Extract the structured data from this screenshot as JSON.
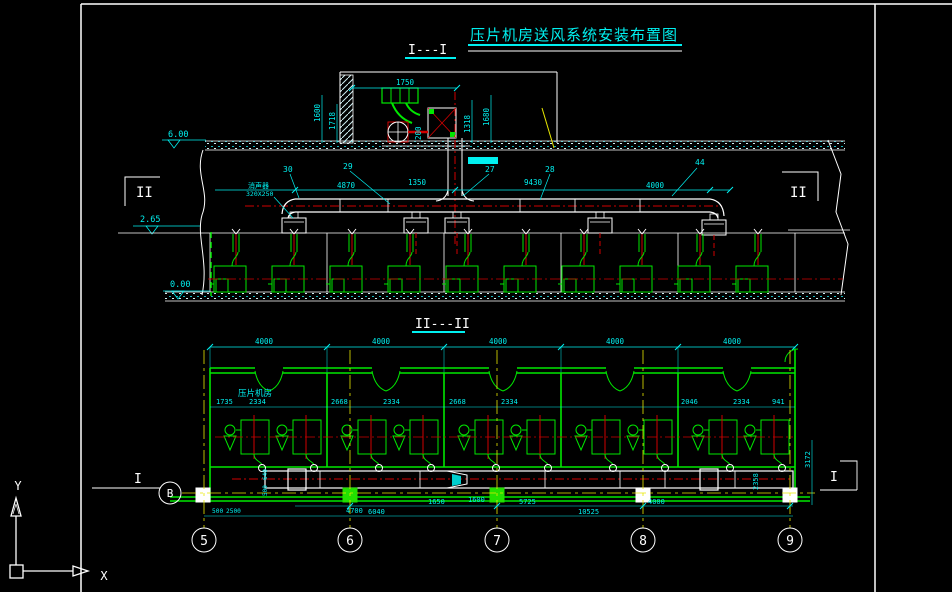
{
  "colors": {
    "bg": "#000000",
    "line": "#FFFFFF",
    "dim": "#00F0F0",
    "wall": "#00E800",
    "duct_center": "#D00000",
    "axis": "#E8E800"
  },
  "title": {
    "text": "压片机房送风系统安装布置图"
  },
  "section_labels": {
    "s1": "I---I",
    "s2": "II---II"
  },
  "elevation": {
    "levels": {
      "roof": "6.00",
      "mid": "2.65",
      "floor": "0.00"
    },
    "marks": {
      "left": "II",
      "right": "II"
    },
    "leaders": {
      "l30": "30",
      "l29": "29",
      "l27": "27",
      "l28": "28",
      "l44": "44"
    },
    "equip_note": {
      "line1": "消声器",
      "line2": "320X250"
    },
    "dims": {
      "d1750": "1750",
      "d200": "200",
      "d1600": "1600",
      "d1718": "1718",
      "d1318": "1318",
      "d1680": "1680",
      "d4870": "4870",
      "d1350": "1350",
      "d9430": "9430",
      "d4000": "4000"
    }
  },
  "plan": {
    "room_label": "压片机房",
    "marks": {
      "left": "I",
      "right": "I"
    },
    "top_dims": [
      "4000",
      "4000",
      "4000",
      "4000",
      "4000"
    ],
    "inner_dims": [
      "1735",
      "2334",
      "2668",
      "2334",
      "2668",
      "2334",
      "2046",
      "2334",
      "941"
    ],
    "bottom_dims": {
      "d500": "500",
      "d2500": "2500",
      "d4700": "4700",
      "d6040": "6040",
      "d1650": "1650",
      "d1600": "1600",
      "d5725": "5725",
      "d10525": "10525",
      "d4000": "4000",
      "d640": "640",
      "d500b": "500"
    },
    "right_dims": {
      "d3172": "3172",
      "d2358": "2358"
    }
  },
  "axes": {
    "cols": [
      "5",
      "6",
      "7",
      "8",
      "9"
    ],
    "row_b": "B"
  },
  "ucs": {
    "x_label": "X",
    "y_label": "Y"
  }
}
